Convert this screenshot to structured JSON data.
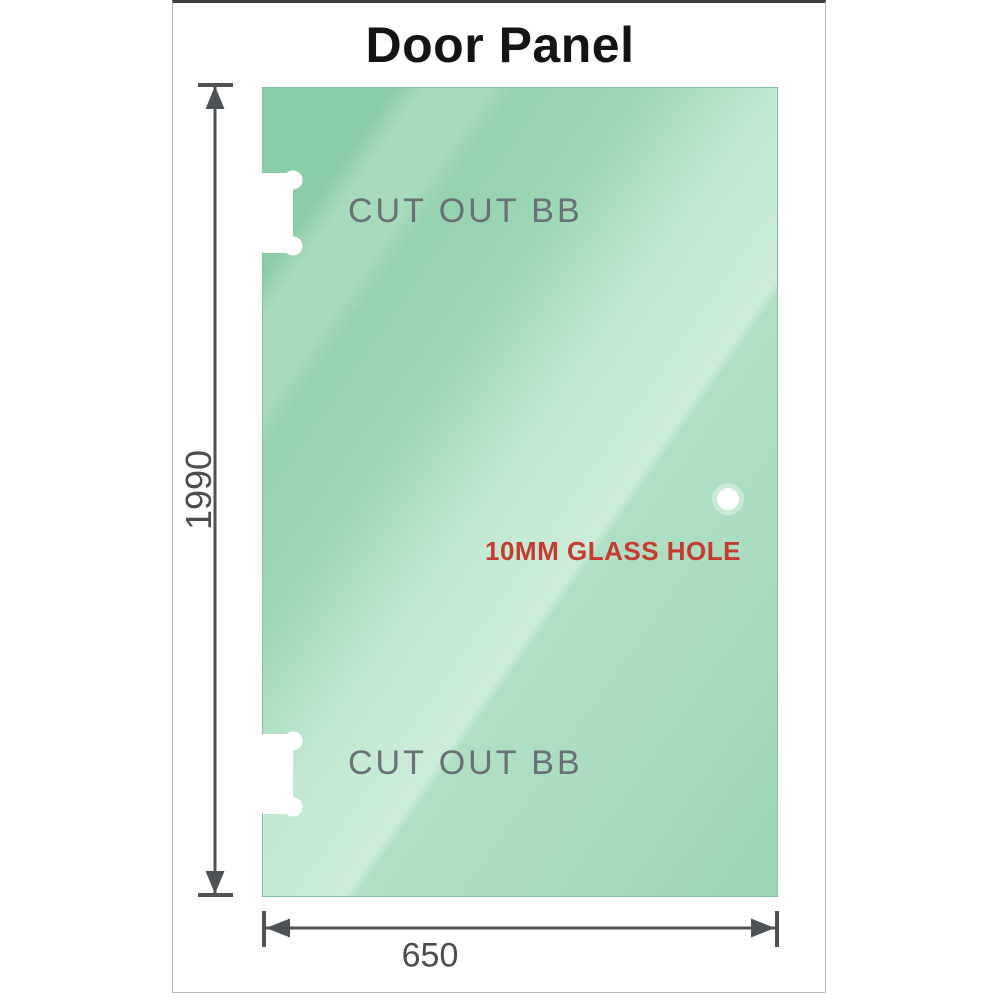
{
  "title": "Door Panel",
  "panel": {
    "cutouts": [
      {
        "position": "top-left",
        "label": "CUT OUT BB"
      },
      {
        "position": "bottom-left",
        "label": "CUT OUT BB"
      }
    ],
    "glass_hole": {
      "label": "10MM GLASS HOLE"
    }
  },
  "dimensions": {
    "height": {
      "label": "1990",
      "orientation": "vertical"
    },
    "width": {
      "label": "650",
      "orientation": "horizontal"
    }
  },
  "colors": {
    "glass_green_dark": "#8bcda6",
    "glass_green_light": "#cbecd8",
    "dimension_line_gray": "#4f5254",
    "hole_label_red": "#c53a31",
    "cutout_text_gray": "#697076",
    "title_black": "#141414",
    "frame_border_gray": "#b5b7b9"
  }
}
